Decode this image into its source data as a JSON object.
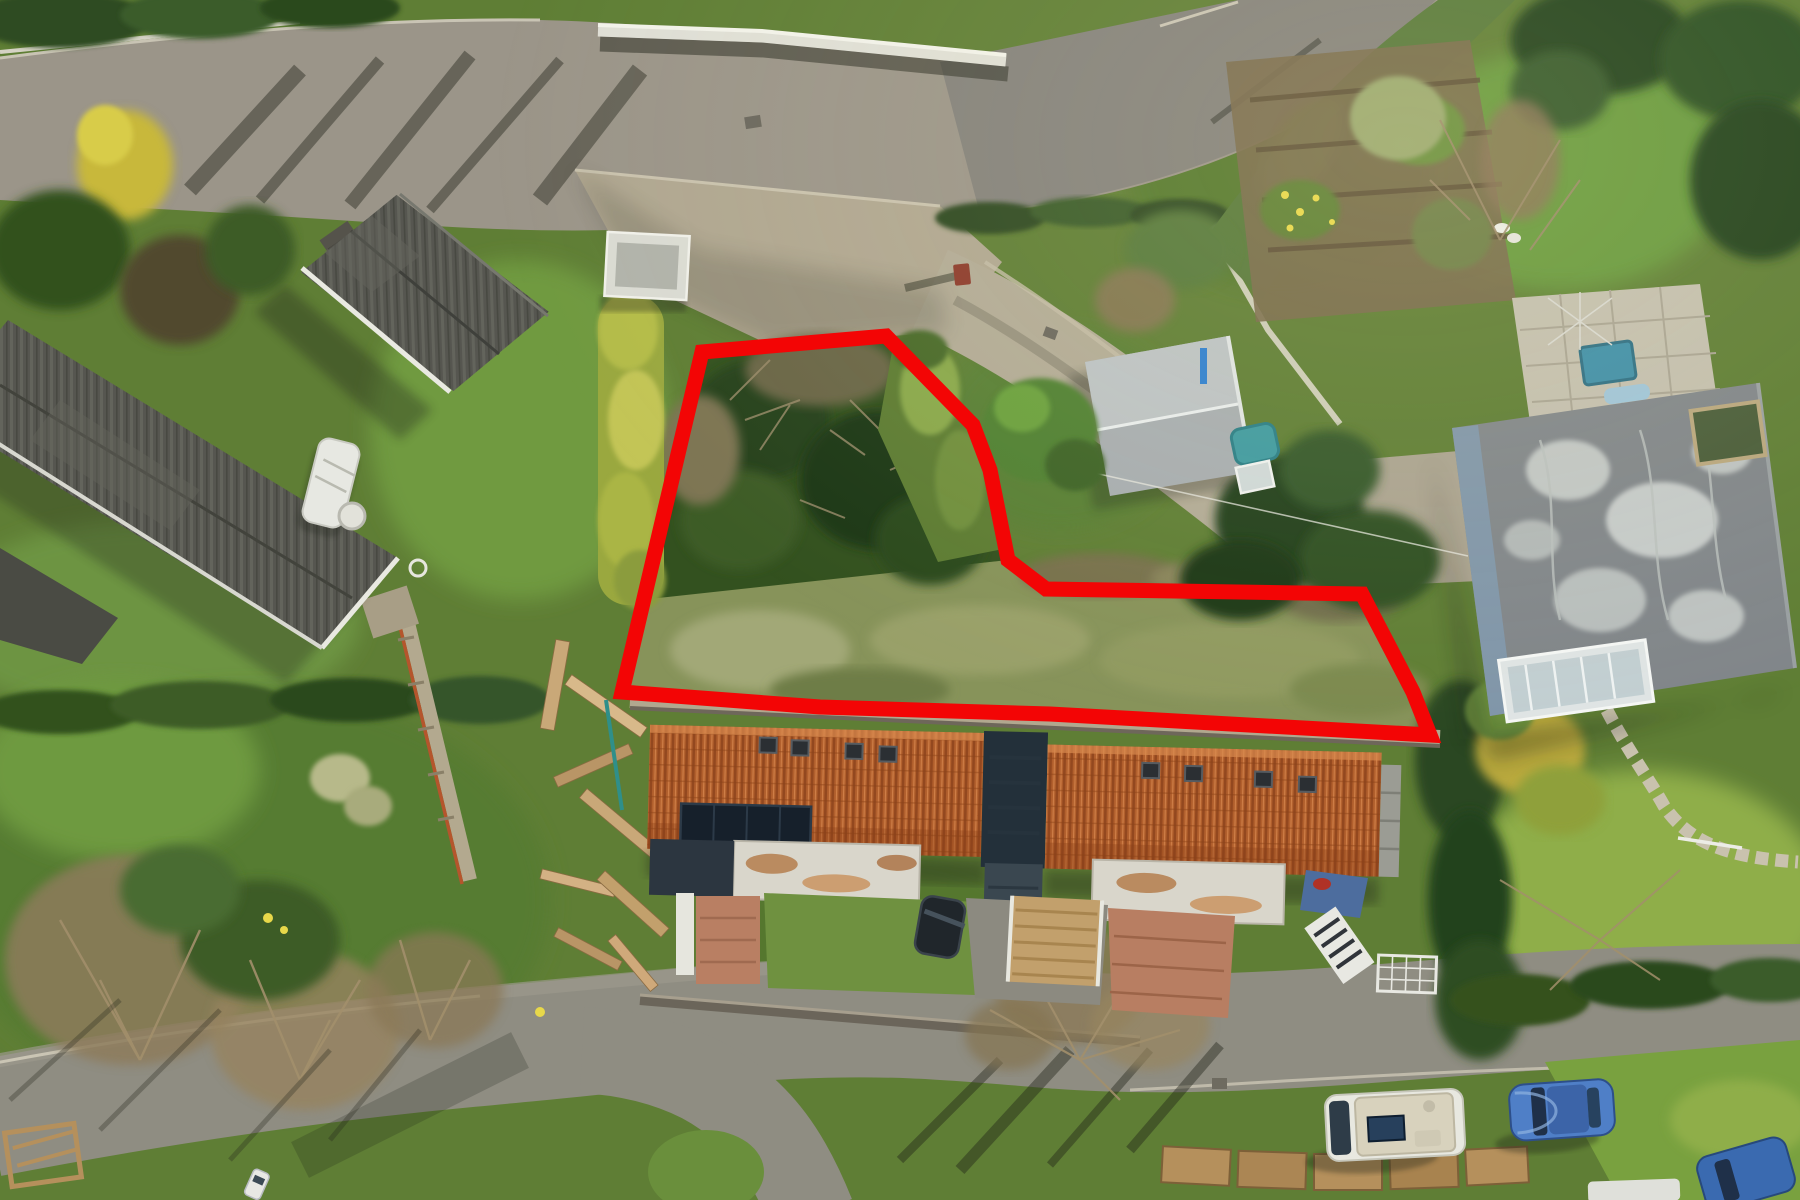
{
  "meta": {
    "kind": "aerial-drone-photograph",
    "width": 1800,
    "height": 1200,
    "description": "Aerial drone photograph of an overgrown building plot outlined with a thick red boundary line, surrounded by dark-roofed bungalows, a pair of terraced houses with terracotta tiled roofs and solar panels, mature gardens, curving suburban roads, a white camper van and a blue car parked on the lower road."
  },
  "annotation": {
    "label": "plot-boundary",
    "color": "#f30505",
    "stroke_width": 15,
    "points": "702,352 886,336 973,425 990,470 1008,560 1046,589 1362,594 1413,692 1430,735 1050,714 820,707 622,692"
  },
  "palette": {
    "road_light": "#9b9589",
    "road_dark": "#84827c",
    "concrete_lane": "#b2ab96",
    "junction": "#b0a791",
    "lawn": "#5f7e35",
    "lawn_bright": "#7fa84b",
    "scrub_dark": "#2c481e",
    "hedge_yellow": "#b4bc4a",
    "terracotta_roof": "#b2602d",
    "dark_roof": "#565650",
    "flat_roof_grey": "#81868a",
    "rust_stain": "#b27845",
    "wall_white": "#dfdfd6",
    "van_white": "#e8e8e0",
    "car_blue": "#4f7fc7",
    "tarp_blue": "#4d6d9e",
    "hot_tub_teal": "#3f9aa0",
    "solar_panel": "#16202b"
  },
  "scene": {
    "roads": [
      {
        "name": "top-road",
        "surface": "asphalt"
      },
      {
        "name": "junction-turning-area",
        "surface": "worn concrete"
      },
      {
        "name": "concrete-lane",
        "surface": "concrete with moss"
      },
      {
        "name": "bottom-road",
        "surface": "asphalt"
      }
    ],
    "buildings": [
      {
        "name": "top-left-bungalow",
        "roof": "dark grey felt"
      },
      {
        "name": "lower-left-bungalow",
        "roof": "dark grey felt"
      },
      {
        "name": "garden-shed",
        "roof": "pale grey metal"
      },
      {
        "name": "right-flat-roof-house",
        "roof": "grey with dried light stains and conservatory"
      },
      {
        "name": "terraced-house-left",
        "roof": "terracotta corrugated with solar panels and skylights"
      },
      {
        "name": "terraced-house-right",
        "roof": "terracotta corrugated with skylights"
      }
    ],
    "vehicles": [
      {
        "name": "camper-van",
        "color": "white",
        "location": "bottom road"
      },
      {
        "name": "hatchback",
        "color": "blue",
        "location": "bottom road"
      },
      {
        "name": "corner-car",
        "color": "blue",
        "location": "bottom right corner"
      },
      {
        "name": "driveway-car",
        "color": "black",
        "location": "left house carport"
      },
      {
        "name": "distant-car",
        "color": "white",
        "location": "bottom left road"
      }
    ],
    "features": [
      "red plot boundary",
      "overgrown scrub inside plot",
      "chartreuse hedge on plot west side",
      "timber plank woodpile on slope",
      "white retaining wall by junction",
      "vegetable beds",
      "paved patio with blue table",
      "bare winter trees with long shadows",
      "conifer hedges",
      "wooden fence along lower road"
    ]
  }
}
